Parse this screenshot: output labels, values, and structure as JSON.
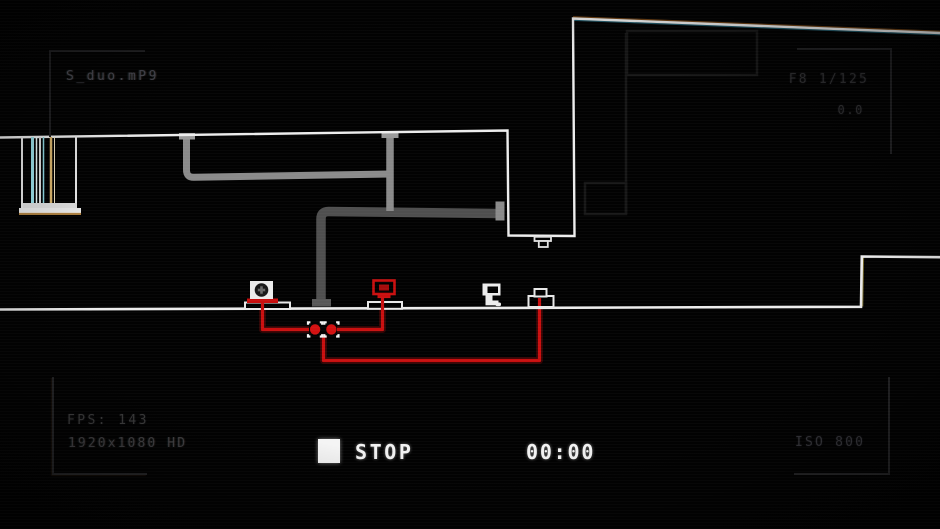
{
  "viewport": {
    "kind": "game-viewport-with-camcorder-overlay",
    "width": 940,
    "height": 529,
    "background": "#000000"
  },
  "hud": {
    "top_left": {
      "filename": "S_duo.mP9"
    },
    "top_right": {
      "aperture_shutter": "F8 1/125",
      "exposure": "0.0"
    },
    "bottom_left": {
      "fps": "FPS: 143",
      "resolution": "1920x1080 HD"
    },
    "bottom_right": {
      "iso": "ISO 800"
    },
    "transport": {
      "status_label": "STOP",
      "timecode": "00:00",
      "icon": "stop-square-icon"
    }
  },
  "scene": {
    "outline_color": "#ededed",
    "wire_color": "#c90f0f",
    "pipe_light_color": "#8a8a8a",
    "pipe_dark_color": "#4f4f4f",
    "objects": [
      {
        "name": "glitch-pillar",
        "colors": [
          "#ececec",
          "#9adfe8",
          "#d8b36a"
        ]
      },
      {
        "name": "speaker-device",
        "body": "#ececec",
        "base": "#c90f0f"
      },
      {
        "name": "red-crt-monitor",
        "color": "#c90f0f",
        "platform": "#ededed"
      },
      {
        "name": "computer-terminal",
        "color": "#ececec"
      },
      {
        "name": "button-pedestal",
        "color": "#ededed",
        "wired": true
      },
      {
        "name": "ceiling-lamp",
        "color": "#e0e0e0"
      },
      {
        "name": "wire-node",
        "count": 2,
        "node_color": "#d31111",
        "bracket_color": "#f5f5f5"
      }
    ]
  },
  "colors": {
    "hud_bright": "#f2f2f2",
    "hud_dim": "#3a3a3a",
    "viewfinder_bracket": "#1e1e20",
    "accent_red": "#c90f0f"
  }
}
